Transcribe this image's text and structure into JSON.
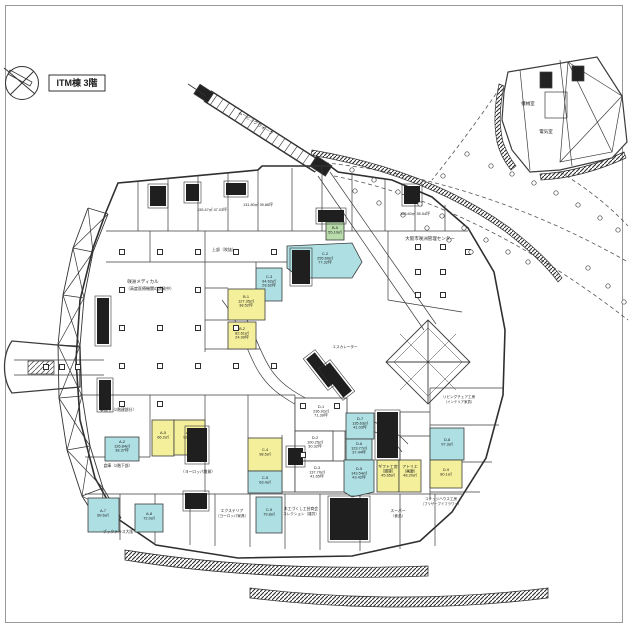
{
  "title": "ITM棟 3階",
  "plan": {
    "colors": {
      "cyan": "#aedfe3",
      "yellow": "#f4ef9b",
      "green": "#b9dcab",
      "line": "#3c3c3c"
    },
    "rooms": [
      {
        "id": "d1",
        "rect": [
          295,
          398,
          52,
          33
        ],
        "color": "white",
        "lines": [
          "D-1",
          "236.92㎡",
          "71.39坪"
        ],
        "lx": 321,
        "ly": 408
      },
      {
        "id": "d2",
        "rect": [
          295,
          431,
          38,
          30
        ],
        "color": "white",
        "lines": [
          "D-2",
          "100.25㎡",
          "30.32坪"
        ],
        "lx": 315,
        "ly": 439
      },
      {
        "id": "d3",
        "rect": [
          295,
          461,
          52,
          31
        ],
        "color": "white",
        "lines": [
          "D-3",
          "137.70㎡",
          "41.65坪"
        ],
        "lx": 317,
        "ly": 469
      },
      {
        "id": "d7",
        "rect": [
          346,
          413,
          28,
          26
        ],
        "color": "cyan",
        "lines": [
          "D-7",
          "135.63㎡",
          "41.03坪"
        ],
        "lx": 360,
        "ly": 420
      },
      {
        "id": "d6",
        "rect": [
          346,
          439,
          26,
          21
        ],
        "color": "cyan",
        "lines": [
          "D-6",
          "123.77㎡",
          "37.44坪"
        ],
        "lx": 359,
        "ly": 445
      },
      {
        "id": "d5",
        "poly": [
          [
            344,
            460
          ],
          [
            374,
            460
          ],
          [
            374,
            492
          ],
          [
            352,
            497
          ],
          [
            344,
            492
          ]
        ],
        "color": "cyan",
        "lines": [
          "D-5",
          "143.54㎡",
          "43.42坪"
        ],
        "lx": 359,
        "ly": 470
      },
      {
        "id": "d4a",
        "rect": [
          377,
          460,
          22,
          32
        ],
        "color": "yellow",
        "lines": [
          "ギフト工房",
          "（雑貨）",
          "45.65㎡"
        ],
        "lx": 388,
        "ly": 468
      },
      {
        "id": "d4b",
        "rect": [
          399,
          460,
          22,
          32
        ],
        "color": "yellow",
        "lines": [
          "アトリエ",
          "（画廊）",
          "48.20㎡"
        ],
        "lx": 410,
        "ly": 468
      },
      {
        "id": "c2",
        "poly": [
          [
            287,
            246
          ],
          [
            352,
            243
          ],
          [
            362,
            262
          ],
          [
            352,
            278
          ],
          [
            300,
            278
          ],
          [
            287,
            268
          ]
        ],
        "color": "cyan",
        "lines": [
          "C-2",
          "255.60㎡",
          "77.32坪"
        ],
        "lx": 325,
        "ly": 255
      },
      {
        "id": "c3",
        "rect": [
          256,
          268,
          26,
          33
        ],
        "color": "cyan",
        "lines": [
          "C-3",
          "94.62㎡",
          "28.62坪"
        ],
        "lx": 269,
        "ly": 278
      },
      {
        "id": "b1",
        "rect": [
          228,
          289,
          37,
          31
        ],
        "color": "yellow",
        "lines": [
          "B-1",
          "127.35㎡",
          "38.52坪"
        ],
        "lx": 246,
        "ly": 298
      },
      {
        "id": "b2",
        "rect": [
          228,
          322,
          28,
          27
        ],
        "color": "yellow",
        "lines": [
          "B-2",
          "82.61㎡",
          "24.99坪"
        ],
        "lx": 242,
        "ly": 330
      },
      {
        "id": "b5",
        "rect": [
          326,
          222,
          18,
          18
        ],
        "color": "green",
        "lines": [
          "B-5",
          "55.10㎡"
        ],
        "lx": 335,
        "ly": 229
      },
      {
        "id": "a5",
        "rect": [
          152,
          420,
          22,
          36
        ],
        "color": "yellow",
        "lines": [
          "A-5",
          "66.2㎡"
        ],
        "lx": 163,
        "ly": 434
      },
      {
        "id": "a6",
        "rect": [
          174,
          420,
          31,
          35
        ],
        "color": "yellow",
        "lines": [
          "A-6",
          "92.5㎡"
        ],
        "lx": 189,
        "ly": 434
      },
      {
        "id": "a2",
        "rect": [
          105,
          437,
          34,
          24
        ],
        "color": "cyan",
        "lines": [
          "A-2",
          "126.84㎡",
          "38.37坪"
        ],
        "lx": 122,
        "ly": 443
      },
      {
        "id": "c4",
        "rect": [
          248,
          438,
          34,
          33
        ],
        "color": "yellow",
        "lines": [
          "C-4",
          "98.5㎡"
        ],
        "lx": 265,
        "ly": 451
      },
      {
        "id": "c5",
        "rect": [
          248,
          471,
          34,
          22
        ],
        "color": "cyan",
        "lines": [
          "C-5",
          "63.4㎡"
        ],
        "lx": 265,
        "ly": 479
      },
      {
        "id": "d8",
        "rect": [
          430,
          428,
          34,
          32
        ],
        "color": "cyan",
        "lines": [
          "D-8",
          "97.3㎡"
        ],
        "lx": 447,
        "ly": 441
      },
      {
        "id": "d9",
        "rect": [
          430,
          460,
          32,
          28
        ],
        "color": "yellow",
        "lines": [
          "D-9",
          "80.1㎡"
        ],
        "lx": 446,
        "ly": 471
      },
      {
        "id": "a7",
        "rect": [
          88,
          498,
          31,
          34
        ],
        "color": "cyan",
        "lines": [
          "A-7",
          "89.6㎡"
        ],
        "lx": 103,
        "ly": 512
      },
      {
        "id": "a8",
        "rect": [
          135,
          504,
          28,
          28
        ],
        "color": "cyan",
        "lines": [
          "A-8",
          "72.0㎡"
        ],
        "lx": 149,
        "ly": 515
      },
      {
        "id": "c9",
        "rect": [
          256,
          497,
          26,
          36
        ],
        "color": "cyan",
        "lines": [
          "C-9",
          "79.8㎡"
        ],
        "lx": 269,
        "ly": 511
      }
    ],
    "labels": [
      {
        "id": "walkway-label",
        "text": "ムービングウォーク",
        "x": 255,
        "y": 124,
        "size": 4.5,
        "rot": 33
      },
      {
        "id": "osaka-center-label",
        "text": "大阪市咲洲管理センター",
        "x": 430,
        "y": 240,
        "size": 4.5
      },
      {
        "id": "medical-label-1",
        "text": "咲洲メディカル",
        "x": 143,
        "y": 283,
        "size": 4.5
      },
      {
        "id": "medical-label-2",
        "text": "（高度医療機関の誘致中）",
        "x": 150,
        "y": 290,
        "size": 4
      },
      {
        "id": "wing-room-1",
        "text": "機械室",
        "x": 528,
        "y": 105,
        "size": 4.5
      },
      {
        "id": "wing-room-2",
        "text": "電気室",
        "x": 546,
        "y": 133,
        "size": 4.5
      },
      {
        "id": "void-label",
        "text": "上部（吹抜）",
        "x": 224,
        "y": 251,
        "size": 4
      },
      {
        "id": "band-area-1",
        "text": "155.47㎡ 47.03坪",
        "x": 212,
        "y": 211,
        "size": 3.8
      },
      {
        "id": "band-area-2",
        "text": "131.80㎡ 39.86坪",
        "x": 258,
        "y": 206,
        "size": 3.8
      },
      {
        "id": "band-area-3",
        "text": "183.60㎡ 55.54坪",
        "x": 415,
        "y": 215,
        "size": 3.8
      },
      {
        "id": "shop-eur-goods",
        "text": "（ヨーロッパ雑貨）",
        "x": 198,
        "y": 473,
        "size": 3.8
      },
      {
        "id": "office-label",
        "text": "事務所（2階建部分）",
        "x": 118,
        "y": 411,
        "size": 3.8
      },
      {
        "id": "storage-label",
        "text": "倉庫（2階下部）",
        "x": 118,
        "y": 467,
        "size": 3.8
      },
      {
        "id": "book-label",
        "text": "ブックテラス大阪",
        "x": 118,
        "y": 533,
        "size": 3.8
      },
      {
        "id": "shop-exterior-1",
        "text": "エクステリア",
        "x": 232,
        "y": 512,
        "size": 3.8
      },
      {
        "id": "shop-exterior-2",
        "text": "（ヨーロッパ家具）",
        "x": 232,
        "y": 517,
        "size": 3.6
      },
      {
        "id": "shop-craft-1",
        "text": "木工づくし工芸商会",
        "x": 301,
        "y": 510,
        "size": 3.8
      },
      {
        "id": "shop-craft-2",
        "text": "コレクション（雑貨）",
        "x": 301,
        "y": 515,
        "size": 3.6
      },
      {
        "id": "shop-super-1",
        "text": "スーパー",
        "x": 398,
        "y": 512,
        "size": 3.8
      },
      {
        "id": "shop-super-2",
        "text": "（食品）",
        "x": 398,
        "y": 517,
        "size": 3.6
      },
      {
        "id": "shop-cottage-1",
        "text": "コテッジハウス工房",
        "x": 441,
        "y": 500,
        "size": 3.6
      },
      {
        "id": "shop-cottage-2",
        "text": "（プリザーブドフラワー）",
        "x": 441,
        "y": 505,
        "size": 3.4
      },
      {
        "id": "interior-studio-1",
        "text": "リビングチェア工房",
        "x": 459,
        "y": 398,
        "size": 3.6
      },
      {
        "id": "interior-studio-2",
        "text": "（インテリア家具）",
        "x": 459,
        "y": 403,
        "size": 3.4
      },
      {
        "id": "escalator-label",
        "text": "エスカレーター",
        "x": 345,
        "y": 348,
        "size": 3.6
      }
    ]
  }
}
